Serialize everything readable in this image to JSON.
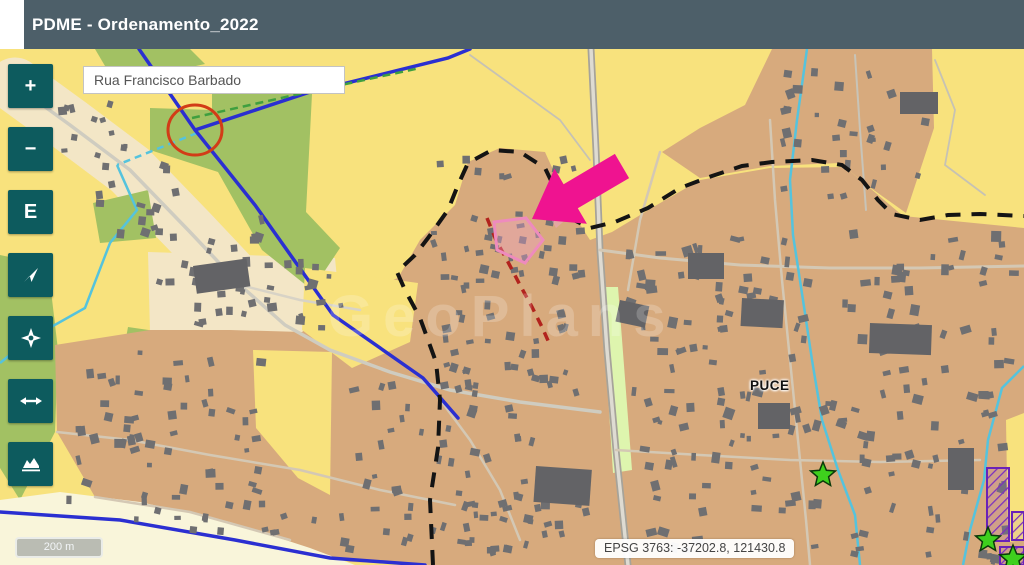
{
  "header": {
    "title": "PDME - Ordenamento_2022"
  },
  "search": {
    "value": "Rua Francisco Barbado"
  },
  "toolbar": {
    "zoom_in_label": "+",
    "zoom_out_label": "−",
    "extent_label": "E"
  },
  "map": {
    "place_label": "PUCE",
    "watermark": "GeoPlans",
    "annotation_colors": {
      "arrow_pink": "#ef1390",
      "circle_red": "#d23c17",
      "route_red": "#b2231d",
      "selection_pink": "#ee8bbd",
      "star_green": "#3ed01d",
      "hatch_purple": "#7a2fc0"
    },
    "legend_colors": {
      "urban_tan": "#d7aa7d",
      "field_yellow": "#f8e27d",
      "green_zone": "#a2c163",
      "village_cream": "#f3e6c6",
      "pale_cream": "#f9f5da",
      "building_gray": "#6f6f71",
      "road_blue": "#2b2fd1",
      "stream_cyan": "#55c3dd",
      "boundary_black": "#141414",
      "strip_pale_green": "#def5ae"
    }
  },
  "scalebar": {
    "label": "200 m"
  },
  "statusbar": {
    "coordinates": "EPSG 3763: -37202.8, 121430.8"
  },
  "ui_colors": {
    "header_bg": "#4d5f69",
    "button_bg": "#0d5b5e"
  }
}
